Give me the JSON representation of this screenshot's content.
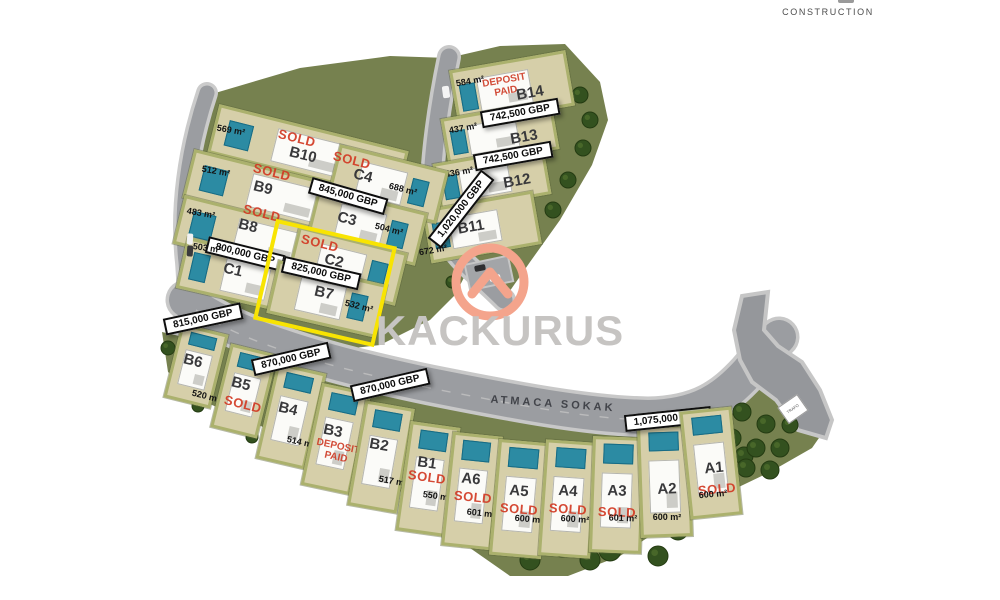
{
  "branding": {
    "logo_text": "KACKURUS",
    "construction_label": "CONSTRUCTION",
    "logo_accent_color": "#f4a48c",
    "logo_text_color": "#c6c4c2"
  },
  "street": {
    "name": "ATMACA SOKAK"
  },
  "facility": {
    "trafo_label": "TRAFO"
  },
  "legend": {
    "sold_label": "SOLD",
    "deposit_label": "DEPOSIT PAID",
    "sold_color": "#d23a24",
    "highlight_color": "#f8e402",
    "currency": "GBP"
  },
  "plots": [
    {
      "id": "B14",
      "status": "deposit-paid",
      "price": null,
      "area": "584 m²",
      "highlighted": false
    },
    {
      "id": "B13",
      "status": "available",
      "price": "742,500 GBP",
      "area": "437 m²",
      "highlighted": false
    },
    {
      "id": "B12",
      "status": "available",
      "price": "742,500 GBP",
      "area": "436 m²",
      "highlighted": false
    },
    {
      "id": "B11",
      "status": "available",
      "price": "1,020,000 GBP",
      "area": "672 m²",
      "highlighted": false
    },
    {
      "id": "B10",
      "status": "sold",
      "price": null,
      "area": "569 m²",
      "highlighted": false
    },
    {
      "id": "B9",
      "status": "sold",
      "price": null,
      "area": "512 m²",
      "highlighted": false
    },
    {
      "id": "B8",
      "status": "sold",
      "price": null,
      "area": "483 m²",
      "highlighted": false
    },
    {
      "id": "C4",
      "status": "sold",
      "price": null,
      "area": "688 m²",
      "highlighted": false
    },
    {
      "id": "C3",
      "status": "available",
      "price": "845,000 GBP",
      "area": "504 m²",
      "highlighted": false
    },
    {
      "id": "C2",
      "status": "sold",
      "price": null,
      "area": null,
      "highlighted": false
    },
    {
      "id": "C1",
      "status": "available",
      "price": "800,000 GBP",
      "area": "503 m²",
      "highlighted": false
    },
    {
      "id": "B7",
      "status": "available",
      "price": "825,000 GBP",
      "area": "532 m²",
      "highlighted": true
    },
    {
      "id": "B6",
      "status": "available",
      "price": "815,000 GBP",
      "area": "520 m²",
      "highlighted": false
    },
    {
      "id": "B5",
      "status": "sold",
      "price": null,
      "area": null,
      "highlighted": false
    },
    {
      "id": "B4",
      "status": "available",
      "price": "870,000 GBP",
      "area": "514 m²",
      "highlighted": false
    },
    {
      "id": "B3",
      "status": "deposit-paid",
      "price": null,
      "area": null,
      "highlighted": false
    },
    {
      "id": "B2",
      "status": "available",
      "price": "870,000 GBP",
      "area": "517 m²",
      "highlighted": false
    },
    {
      "id": "B1",
      "status": "sold",
      "price": null,
      "area": "550 m²",
      "highlighted": false
    },
    {
      "id": "A6",
      "status": "sold",
      "price": null,
      "area": "601 m²",
      "highlighted": false
    },
    {
      "id": "A5",
      "status": "sold",
      "price": null,
      "area": "600 m²",
      "highlighted": false
    },
    {
      "id": "A4",
      "status": "sold",
      "price": null,
      "area": "600 m²",
      "highlighted": false
    },
    {
      "id": "A3",
      "status": "sold",
      "price": null,
      "area": "601 m²",
      "highlighted": false
    },
    {
      "id": "A2",
      "status": "available",
      "price": "1,075,000 GBP",
      "area": "600 m²",
      "highlighted": false
    },
    {
      "id": "A1",
      "status": "sold",
      "price": null,
      "area": "600 m²",
      "highlighted": false
    }
  ]
}
